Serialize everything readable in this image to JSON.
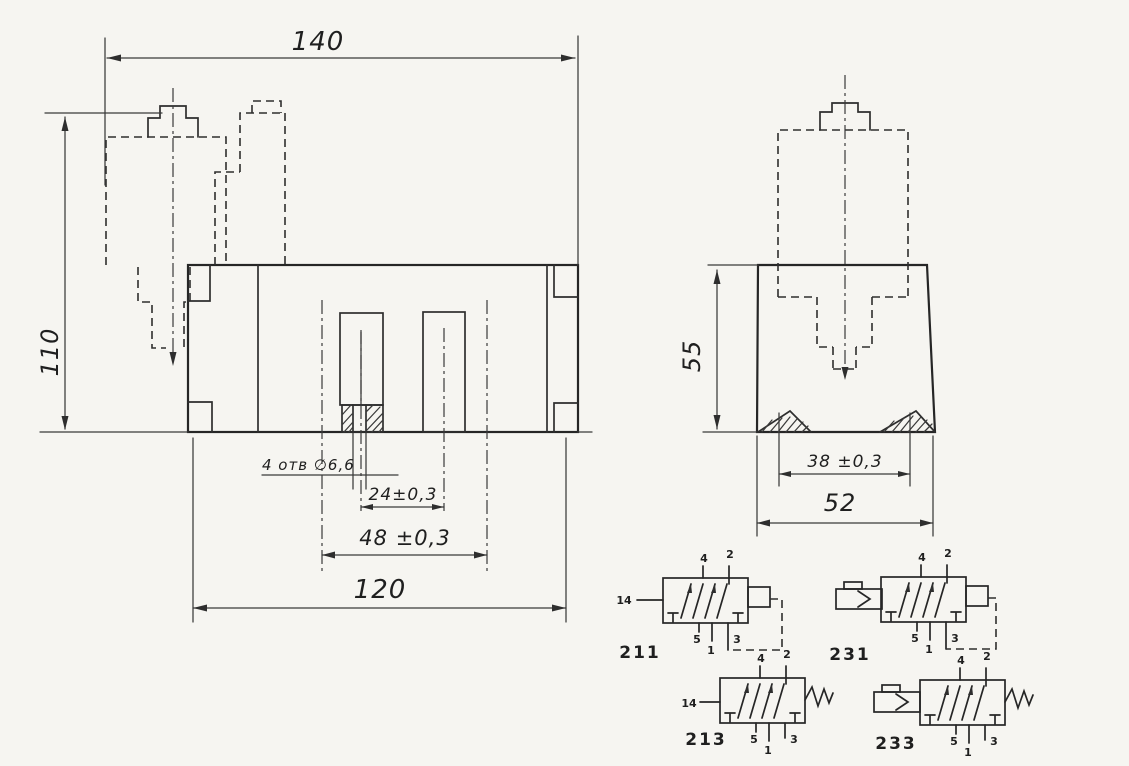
{
  "drawing": {
    "front_view": {
      "dim_overall_width": "140",
      "dim_overall_height": "110",
      "holes_note": "4 отв ∅6,6",
      "dim_holes_pitch": "24±0,3",
      "dim_ports_pitch": "48 ±0,3",
      "dim_base_width": "120"
    },
    "side_view": {
      "dim_body_height": "55",
      "dim_groove_pitch": "38 ±0,3",
      "dim_base_depth": "52"
    },
    "schematics": [
      {
        "label": "211",
        "pilot_port": "14",
        "ports_top": [
          "4",
          "2"
        ],
        "ports_bottom": [
          "5",
          "1",
          "3"
        ]
      },
      {
        "label": "231",
        "ports_top": [
          "4",
          "2"
        ],
        "ports_bottom": [
          "5",
          "1",
          "3"
        ]
      },
      {
        "label": "213",
        "pilot_port": "14",
        "ports_top": [
          "4",
          "2"
        ],
        "ports_bottom": [
          "5",
          "1",
          "3"
        ]
      },
      {
        "label": "233",
        "ports_top": [
          "4",
          "2"
        ],
        "ports_bottom": [
          "5",
          "1",
          "3"
        ]
      }
    ]
  }
}
